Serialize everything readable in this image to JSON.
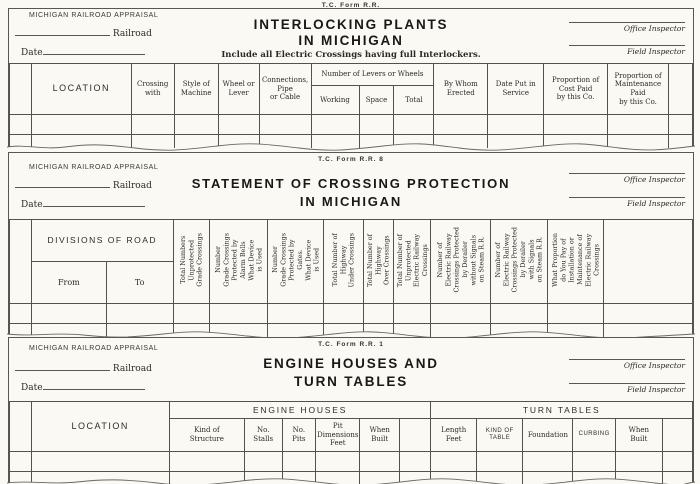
{
  "common": {
    "agency": "MICHIGAN RAILROAD APPRAISAL",
    "railroad_label": "Railroad",
    "date_label": "Date",
    "office_inspector": "Office Inspector",
    "field_inspector": "Field Inspector",
    "paper_color": "#faf9f4",
    "ink_color": "#2b2a26",
    "line_color": "#55524c"
  },
  "f1": {
    "form_no": "T.C. Form R.R.",
    "title1": "INTERLOCKING PLANTS",
    "title2": "IN MICHIGAN",
    "subtitle": "Include all Electric Crossings having full Interlockers.",
    "cols": {
      "location": "LOCATION",
      "crossing_with": "Crossing\nwith",
      "style_machine": "Style of\nMachine",
      "wheel_lever": "Wheel or\nLever",
      "connections": "Connections,\nPipe\nor Cable",
      "levers_group": "Number of Levers or Wheels",
      "working": "Working",
      "space": "Space",
      "total": "Total",
      "by_whom": "By Whom\nErected",
      "date_service": "Date Put in\nService",
      "prop_cost": "Proportion of\nCost Paid\nby this Co.",
      "prop_maint": "Proportion of\nMaintenance\nPaid\nby this Co."
    }
  },
  "f2": {
    "form_no": "T.C. Form R.R. 8",
    "title1": "STATEMENT OF CROSSING PROTECTION",
    "title2": "IN MICHIGAN",
    "cols": {
      "divisions_group": "DIVISIONS OF ROAD",
      "from": "From",
      "to": "To",
      "v1": "Total Numbers\nUnprotected\nGrade Crossings",
      "v2": "Number\nGrade Crossings\nProtected by\nAlarm Bells\nWhat Device\nis Used",
      "v3": "Number\nGrade Crossings\nProtected by\nGates.\nWhat Device\nis Used",
      "v4": "Total Number of\nHighway\nUnder Crossings",
      "v5": "Total Number of\nHighway\nOver Crossings",
      "v6": "Total Number of\nUnprotected\nElectric Railway\nCrossings",
      "v7": "Number of\nElectric Railway\nCrossings Protected\nby Derailer\nwithout Signals\non Steam R.R.",
      "v8": "Number of\nElectric Railway\nCrossings Protected\nby Derailer\nwith Signals\non Steam R.R.",
      "v9": "What Proportion\ndo You Pay of\nInstallation or\nMaintenance of\nElectric Railway\nCrossings"
    }
  },
  "f3": {
    "form_no": "T.C. Form R.R. 1",
    "title1": "ENGINE HOUSES AND",
    "title2": "TURN TABLES",
    "cols": {
      "location": "LOCATION",
      "engine_group": "ENGINE HOUSES",
      "turn_group": "TURN TABLES",
      "kind_structure": "Kind of\nStructure",
      "no_stalls": "No.\nStalls",
      "no_pits": "No.\nPits",
      "pit_dim": "Pit\nDimensions\nFeet",
      "when_built_eh": "When\nBuilt",
      "length_feet": "Length\nFeet",
      "kind_table": "KIND OF\nTABLE",
      "foundation": "Foundation",
      "curbing": "CURBING",
      "when_built_tt": "When\nBuilt"
    }
  }
}
